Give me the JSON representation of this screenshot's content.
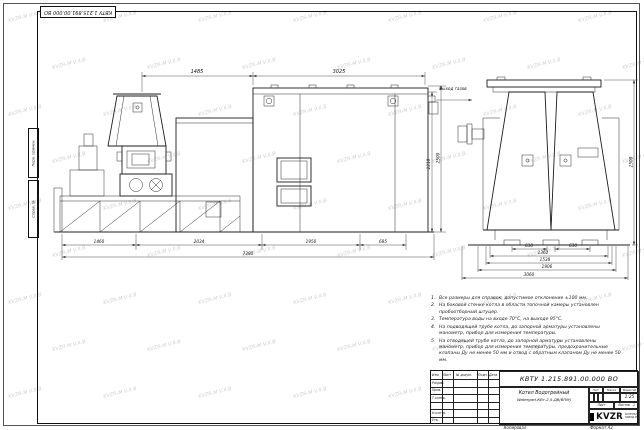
{
  "sheet": {
    "stamp_top_left": "КВТУ 1.215.891.00.000 ВО",
    "watermark_text": "KVZR-M V.X.B",
    "margin_top_label_1": "Перв. примен.",
    "margin_top_label_2": "Справ. №"
  },
  "main_view": {
    "gas_exit_label": "Выход газов",
    "dim_top_left": "1485",
    "dim_top_right": "3025",
    "dim_height_inner": "2210",
    "dim_height_outer": "2500",
    "dim_bottom": [
      "1460",
      "2034",
      "1950",
      "685"
    ],
    "dim_overall": "7280"
  },
  "side_view": {
    "dim_row1_left": "630",
    "dim_row1_right": "630",
    "dim_row2": "1362",
    "dim_row3": "1538",
    "dim_row4": "1906",
    "dim_row5": "3060",
    "dim_height": "2500"
  },
  "notes": {
    "numbers": [
      "1.",
      "2.",
      "3.",
      "4.",
      "5."
    ],
    "items": [
      "Все размеры для справок, допустимое отклонение ±100 мм.",
      "На боковой стенке котла в области топочной камеры установлен пробоотборный штуцер.",
      "Температура воды на входе 70°С, на выходе 95°С.",
      "На подводящей трубе котла, до запорной арматуры установлены манометр, прибор для измерения температуры.",
      "На отводящей трубе котла, до запорной арматуры установлены манометр, прибор для измерения температуры, предохранительные клапаны Ду не менее 50 мм и отвод с обратным клапаном Ду не менее 50 мм."
    ]
  },
  "title_block": {
    "doc_number": "КВТУ 1.215.891.00.000 ВО",
    "col_izm": "Изм.",
    "col_list": "Лист",
    "col_doc": "№ докум.",
    "col_sign": "Подп.",
    "col_date": "Дата",
    "row_razrab": "Разраб.",
    "row_prov": "Пров.",
    "row_tkontr": "Т.контр.",
    "row_nkontr": "Н.контр.",
    "row_utv": "Утв.",
    "name_line1": "Котел Водогрейный",
    "name_line2": "Watergart-КВт-2,5-ДВ(ВПМ)",
    "lit_label": "Лит.",
    "mass_label": "Масса",
    "scale_label": "Масштаб",
    "scale_value": "1:25",
    "sheet_label": "Лист",
    "sheets_label": "Листов",
    "sheets_value": "1",
    "logo_text": "KVZR",
    "logo_sub1": "КОТЕЛЬНЫЙ",
    "logo_sub2": "ЗАВОД.РФ",
    "copied_label": "Копировал",
    "format_label": "Формат А2"
  }
}
